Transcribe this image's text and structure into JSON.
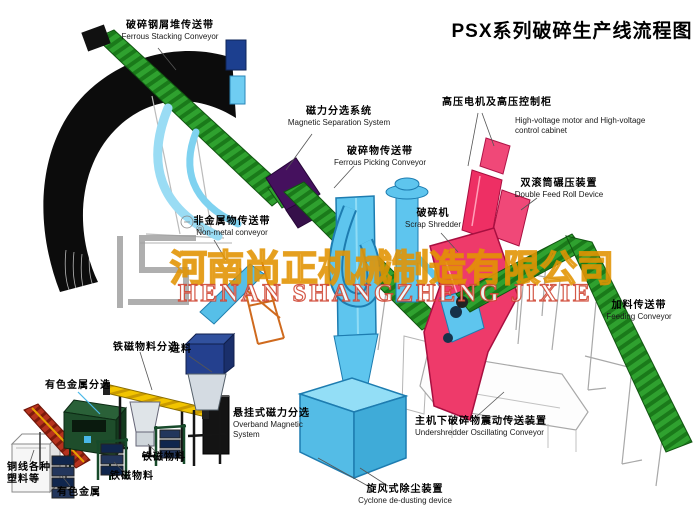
{
  "title": "PSX系列破碎生产线流程图",
  "watermark": {
    "logo_reg": "®",
    "company_zh": "河南尚正机械制造有限公司",
    "company_en": "HENAN SHANGZHENG JIXIE"
  },
  "labels": {
    "ferrous_stacking": {
      "zh": "破碎钢屑堆传送带",
      "en": "Ferrous Stacking Conveyor"
    },
    "magnetic_separation": {
      "zh": "磁力分选系统",
      "en": "Magnetic Separation System"
    },
    "ferrous_picking": {
      "zh": "破碎物传送带",
      "en": "Ferrous Picking Conveyor"
    },
    "hv_cabinet": {
      "zh": "高压电机及高压控制柜",
      "en": "High-voltage motor and High-voltage control cabinet"
    },
    "double_feed_roll": {
      "zh": "双滚筒碾压装置",
      "en": "Double Feed Roll Device"
    },
    "scrap_shredder": {
      "zh": "破碎机",
      "en": "Scrap Shredder"
    },
    "non_metal_conveyor": {
      "zh": "非金属物传送带",
      "en": "Non-metal conveyor"
    },
    "feeding_conveyor": {
      "zh": "加料传送带",
      "en": "Feeding Conveyor"
    },
    "overband_magnet": {
      "zh": "悬挂式磁力分选",
      "en": "Overband Magnetic System"
    },
    "undershredder": {
      "zh": "主机下破碎物震动传送装置",
      "en": "Undershredder Oscillating Conveyor"
    },
    "cyclone": {
      "zh": "旋风式除尘装置",
      "en": "Cyclone de-dusting device"
    },
    "fe_material_sorting": {
      "zh": "铁磁物料分选"
    },
    "feed_in": {
      "zh": "进料"
    },
    "nonferrous_sorting": {
      "zh": "有色金属分选"
    },
    "copper_wire_plastics": {
      "zh": "铜线各种塑料等"
    },
    "nonferrous_metal": {
      "zh": "有色金属"
    },
    "fe_material_a": {
      "zh": "铁磁物料"
    },
    "fe_material_b": {
      "zh": "铁磁物料"
    }
  },
  "colors": {
    "conveyor_green": "#2fa12f",
    "machine_blue": "#5ec5ee",
    "shredder_pink": "#ee3a6a",
    "separator_purple": "#45115e",
    "overband_yellow": "#f2c400",
    "hopper_navy": "#24408e",
    "eddy_green": "#1e4d2b",
    "watermark_gold": "#e8a317",
    "watermark_red": "#cc3c28"
  }
}
